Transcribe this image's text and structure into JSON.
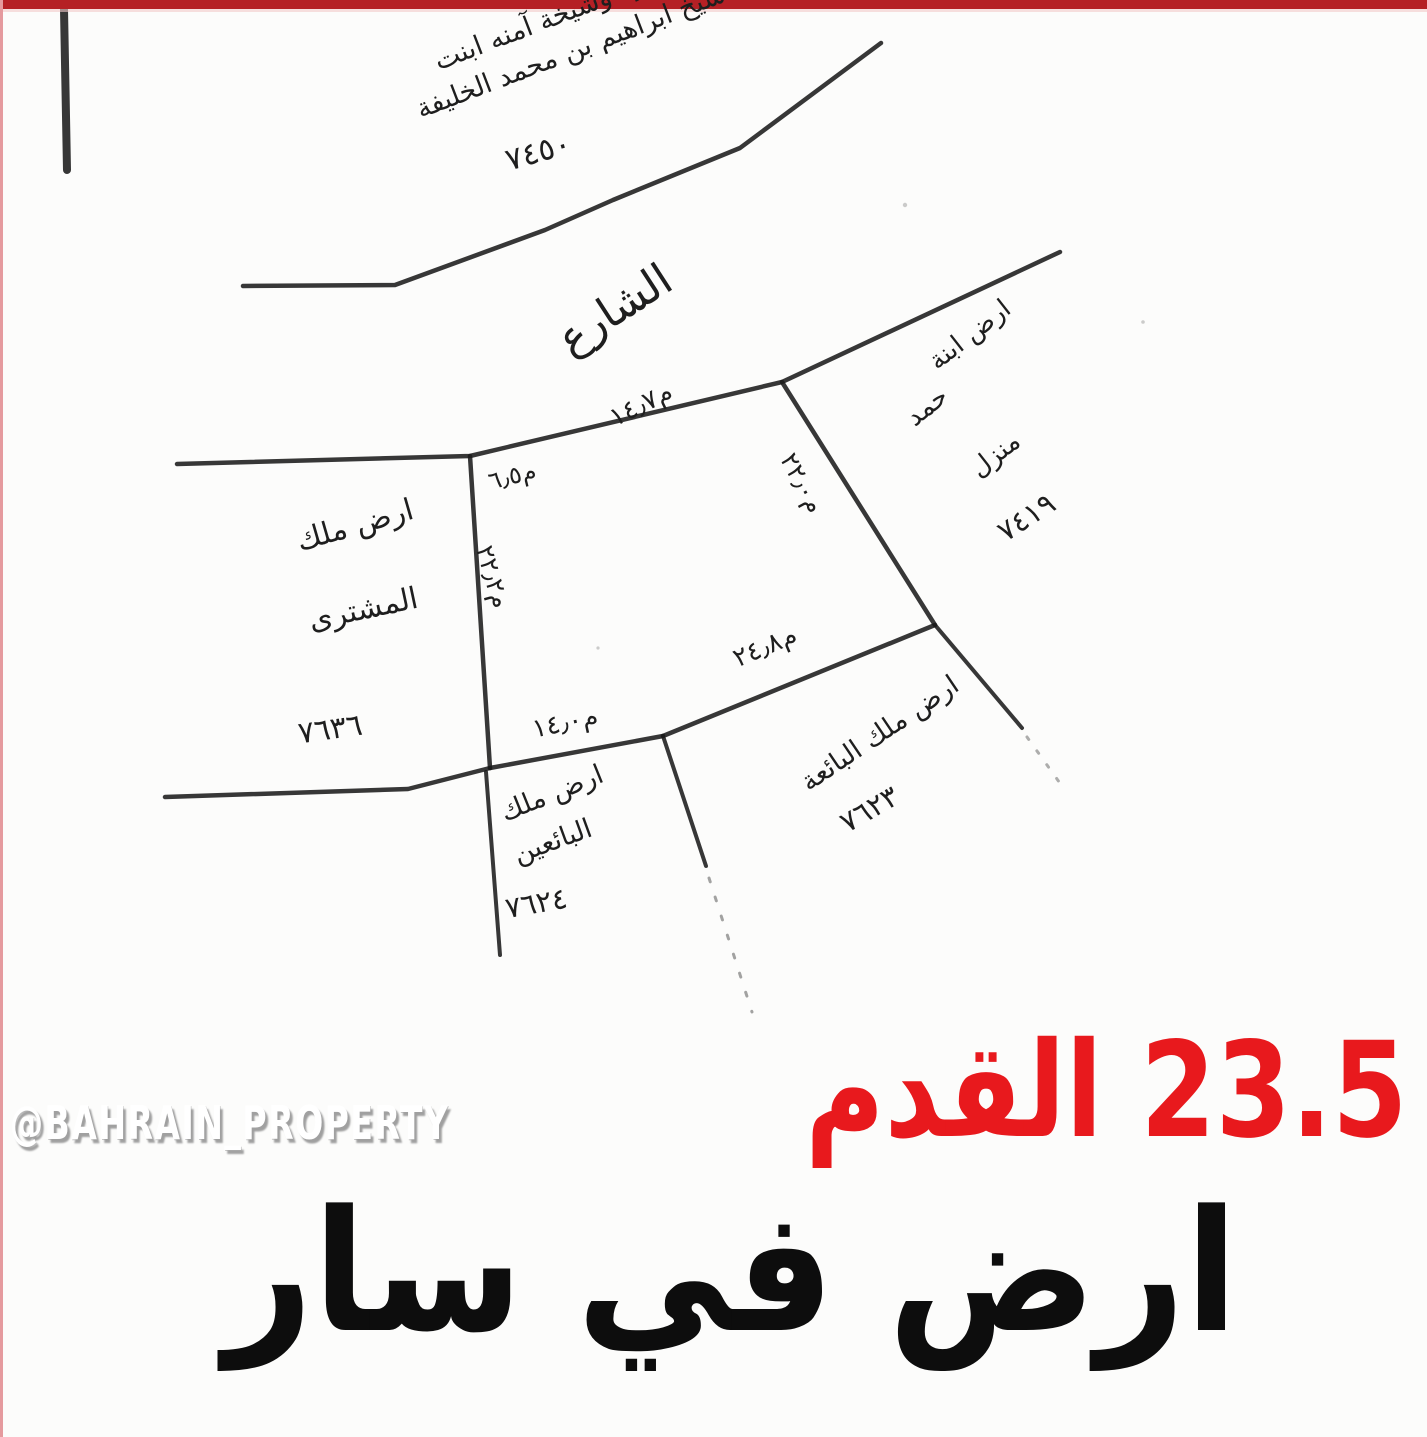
{
  "page": {
    "background": "#fcfcfb",
    "top_border_color": "#b52025",
    "left_border_color": "#e59a9e",
    "ink_color": "#1e1e1e"
  },
  "watermark": {
    "text": "@BAHRAIN_PROPERTY"
  },
  "price": {
    "text": "23.5 القدم",
    "color": "#e8191d"
  },
  "title": {
    "text": "ارض في سار"
  },
  "sketch": {
    "street_label": "الشارع",
    "owners": {
      "top": {
        "line1": "شيخة موزه وشيخة آمنه ابنت",
        "line2": "شيخ ابراهيم بن محمد الخليفة",
        "number": "٧٤٥٠"
      },
      "right": {
        "line1": "ارض ابنة",
        "line2": "حمد",
        "line3": "منزل",
        "number": "٧٤١٩"
      },
      "left": {
        "line1": "ارض ملك",
        "line2": "المشترى",
        "number": "٧٦٣٦"
      },
      "bottom_left": {
        "line1": "ارض ملك",
        "line2": "البائعين",
        "number": "٧٦٢٤"
      },
      "bottom_right": {
        "line1": "ارض ملك البائعة",
        "number": "٧٦٢٣"
      }
    },
    "measurements": {
      "front_left": "م٦٫٥",
      "front": "م١٤٫٧",
      "side_right": "م٢٢٫٠",
      "side_left": "م٢٢٫٢",
      "back_right": "م٢٤٫٨",
      "back": "م١٤٫٠"
    }
  }
}
